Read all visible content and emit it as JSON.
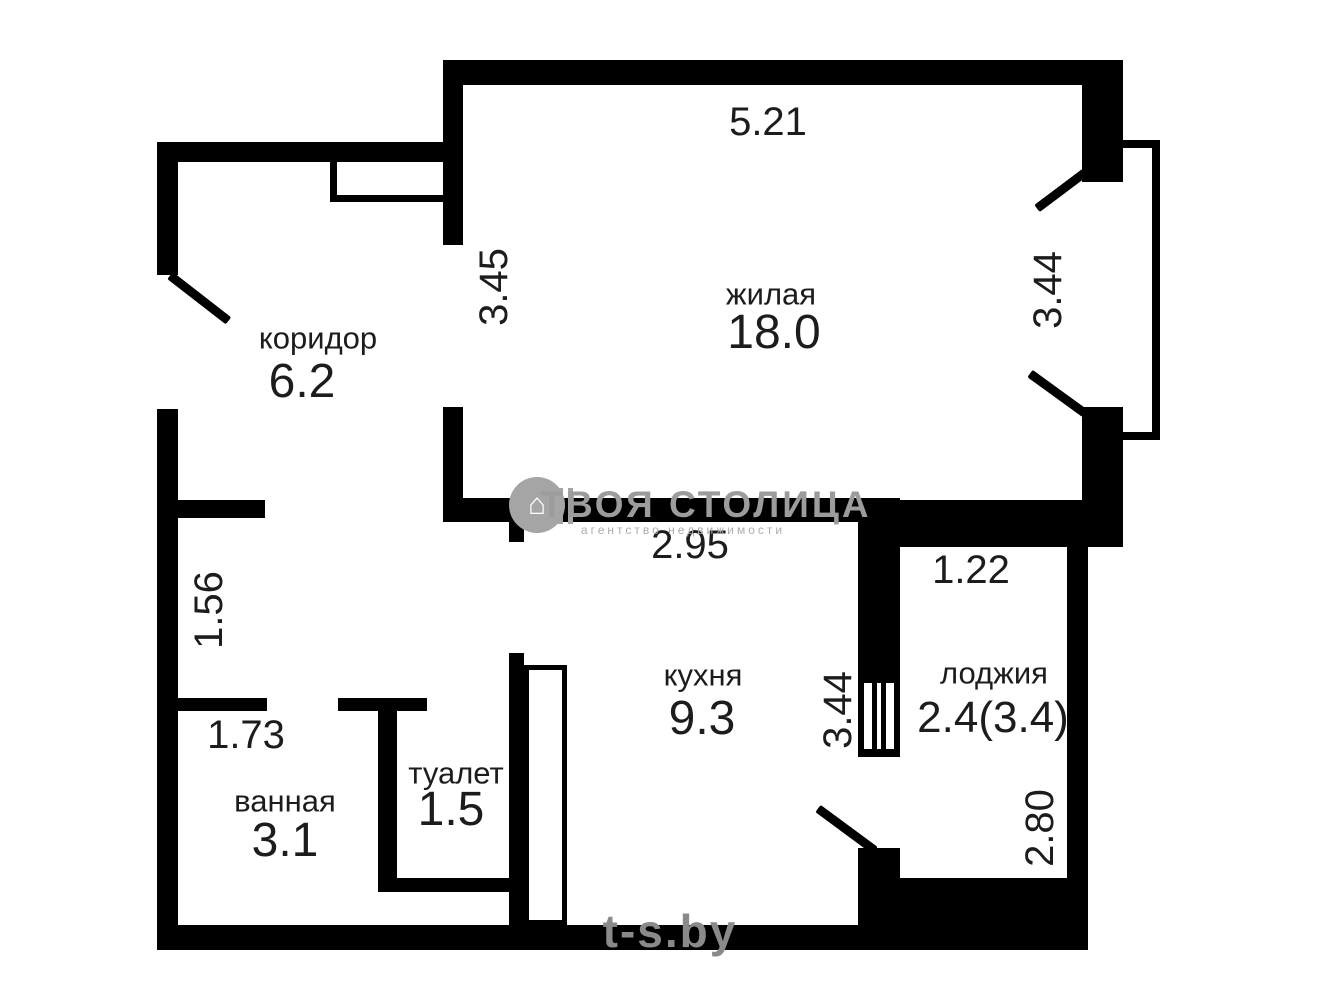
{
  "rooms": {
    "living": {
      "name": "жилая",
      "area": "18.0"
    },
    "corridor": {
      "name": "коридор",
      "area": "6.2"
    },
    "kitchen": {
      "name": "кухня",
      "area": "9.3"
    },
    "bathroom": {
      "name": "ванная",
      "area": "3.1"
    },
    "toilet": {
      "name": "туалет",
      "area": "1.5"
    },
    "loggia": {
      "name": "лоджия",
      "area": "2.4(3.4)"
    }
  },
  "dimensions": {
    "living_width": "5.21",
    "living_height_left": "3.45",
    "living_height_right": "3.44",
    "kitchen_width": "2.95",
    "kitchen_loggia_opening": "3.44",
    "loggia_width": "1.22",
    "loggia_height": "2.80",
    "hall_width": "1.56",
    "bathroom_width": "1.73"
  },
  "watermark": {
    "brand": "ТВОЯ СТОЛИЦА",
    "tagline": "агентство недвижимости",
    "site": "t-s.by"
  },
  "colors": {
    "wall": "#000000",
    "background": "#ffffff",
    "text": "#1c1c1c",
    "watermark_grey": "#9c9c9c"
  }
}
